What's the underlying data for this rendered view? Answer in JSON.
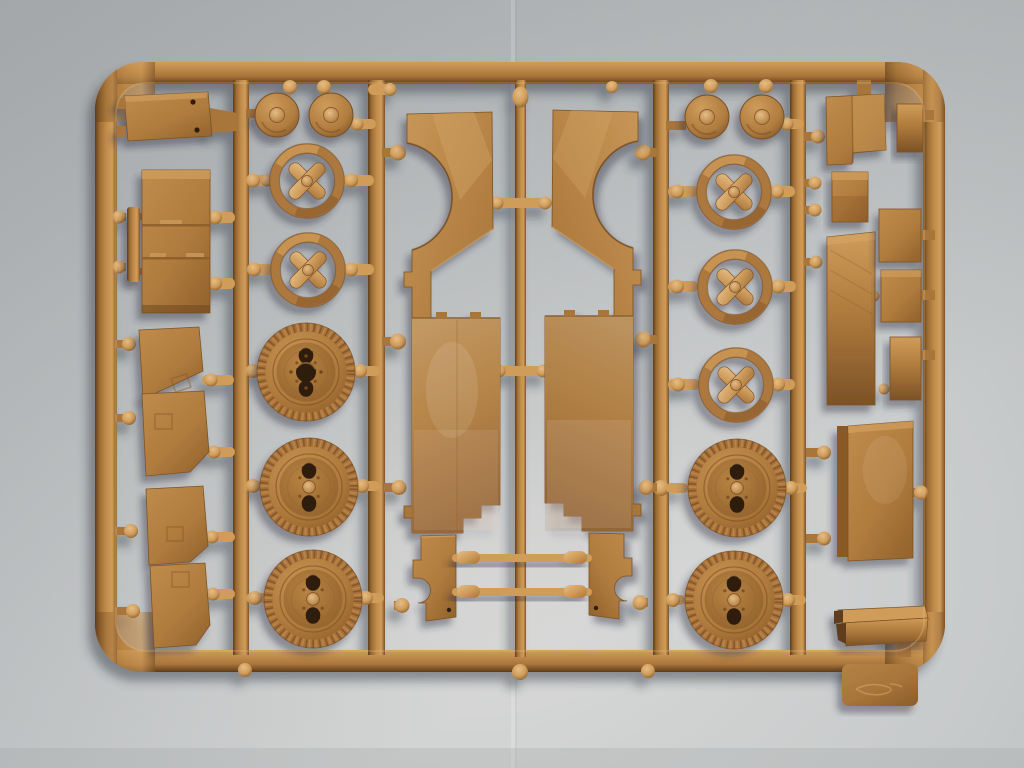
{
  "scene": {
    "type": "photograph",
    "subject": "Injection-molded tan plastic model kit sprue (parts tree) with truck wheels, hubs and body panels, photographed top-down on light grey paper",
    "material": "tan styrene plastic",
    "lighting": "soft daylight from upper right, shadows cast down-left",
    "visible_text": "none legible; faint embossed maker's mark on the small tab below the bottom rail"
  },
  "palette": {
    "bg_edge": "#b2b5b6",
    "bg_dark": "#a3a7a9",
    "bg_light": "#dcdcda",
    "bg_mid": "#c7cacb",
    "crease": "#eceme",
    "plastic_base": "#b07c3e",
    "plastic_mid": "#a8743a",
    "plastic_light": "#cf9c5a",
    "plastic_bright": "#e6bd85",
    "plastic_dark": "#7c5226",
    "plastic_deep": "#5e3c1a",
    "hole": "#2e1c0c",
    "shadow": "#2f3142",
    "warm_reflect": "#e8c7b0"
  },
  "sprue": {
    "frame": {
      "shape": "rounded-rectangle",
      "x": 95,
      "y": 62,
      "width": 850,
      "height": 610,
      "corner_radius": 48,
      "bar_thickness": 21,
      "vertical_runners": 5,
      "id_tab": "bottom right, embossed illegible logo"
    },
    "parts_inventory": [
      {
        "name": "mounting-plate",
        "count": 1,
        "zone": "top-left"
      },
      {
        "name": "cargo-box-with-panel-lines",
        "count": 1,
        "zone": "left"
      },
      {
        "name": "side-rail-strip",
        "count": 1,
        "zone": "left"
      },
      {
        "name": "door-panel",
        "count": 4,
        "zone": "lower-left"
      },
      {
        "name": "hub-cap-disc",
        "count": 4,
        "zone": "top of wheel columns"
      },
      {
        "name": "cross-spoke-wheel-hub",
        "count": 5,
        "zone": "wheel columns"
      },
      {
        "name": "road-wheel-tire",
        "count": 5,
        "zone": "wheel columns"
      },
      {
        "name": "body-side-shell",
        "count": 2,
        "zone": "center, mirrored pair"
      },
      {
        "name": "fender-bracket",
        "count": 2,
        "zone": "bottom center, mirrored pair"
      },
      {
        "name": "axle-rod",
        "count": 2,
        "zone": "bottom center"
      },
      {
        "name": "equipment-panel",
        "count": 7,
        "zone": "right column"
      },
      {
        "name": "stowage-box-large",
        "count": 1,
        "zone": "right column"
      },
      {
        "name": "small-cube-block",
        "count": 1,
        "zone": "right column"
      },
      {
        "name": "visor-bar",
        "count": 1,
        "zone": "bottom right"
      },
      {
        "name": "sprue-id-tab",
        "count": 1,
        "zone": "below bottom rail"
      }
    ]
  }
}
